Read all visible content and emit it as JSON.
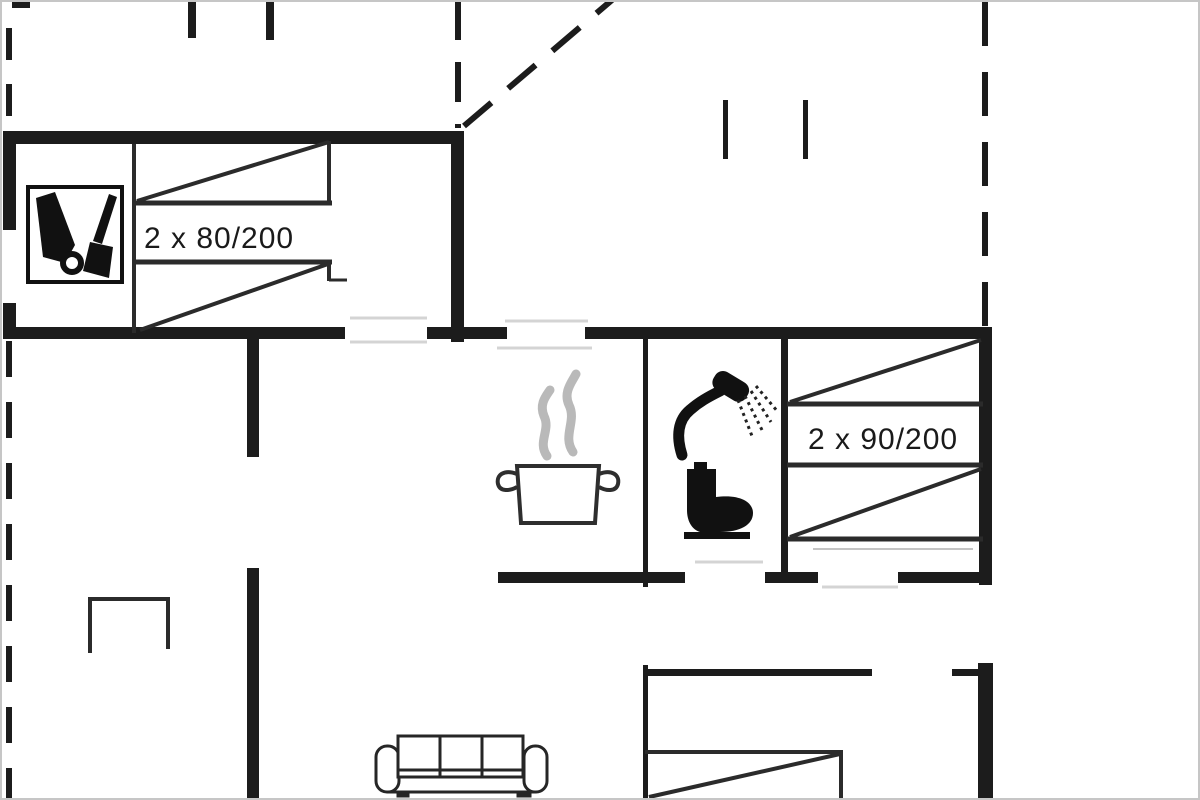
{
  "labels": {
    "bed_left": "2 x 80/200",
    "bed_right": "2 x 90/200"
  },
  "colors": {
    "background": "#ffffff",
    "walls": "#1c1c1c",
    "furniture_lines": "#2b2b2b",
    "icon_fill": "#111111",
    "opening_lines": "#d4d4d4",
    "steam_gray": "#b9b9b9",
    "frame_border": "#c6c6c6"
  },
  "icons": [
    "cleaning-cabinet-icon",
    "steam-icon",
    "cooking-pot-icon",
    "shower-icon",
    "toilet-icon",
    "fireplace-icon",
    "sofa-icon"
  ]
}
